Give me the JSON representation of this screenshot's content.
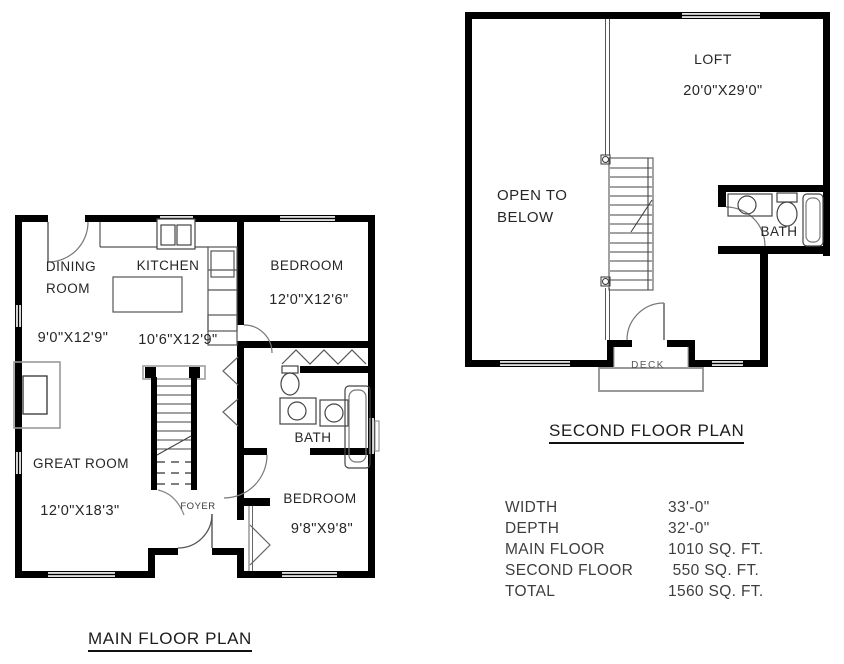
{
  "colors": {
    "wall": "#000000",
    "thin_line": "#4a4a4a",
    "fixture_gray": "#999999",
    "text": "#262626",
    "background": "#ffffff"
  },
  "main_floor": {
    "title": "MAIN FLOOR PLAN",
    "dining": {
      "name_lines": [
        "DINING",
        "ROOM"
      ],
      "dims": "9'0\"X12'9\""
    },
    "kitchen": {
      "name": "KITCHEN",
      "dims": "10'6\"X12'9\""
    },
    "bedroom1": {
      "name": "BEDROOM",
      "dims": "12'0\"X12'6\""
    },
    "great_room": {
      "name": "GREAT ROOM",
      "dims": "12'0\"X18'3\""
    },
    "bath": {
      "name": "BATH"
    },
    "foyer": {
      "name": "FOYER"
    },
    "bedroom2": {
      "name": "BEDROOM",
      "dims": "9'8\"X9'8\""
    }
  },
  "second_floor": {
    "title": "SECOND FLOOR PLAN",
    "loft": {
      "name": "LOFT",
      "dims": "20'0\"X29'0\""
    },
    "open_to_below": {
      "name_lines": [
        "OPEN TO",
        "BELOW"
      ]
    },
    "bath": {
      "name": "BATH"
    },
    "deck": {
      "name": "DECK"
    }
  },
  "stats": {
    "rows": [
      {
        "label": "WIDTH",
        "value": "33'-0\""
      },
      {
        "label": "DEPTH",
        "value": "32'-0\""
      },
      {
        "label": "MAIN FLOOR",
        "value": "1010 SQ. FT."
      },
      {
        "label": "SECOND FLOOR",
        "value": " 550 SQ. FT."
      },
      {
        "label": "TOTAL",
        "value": "1560 SQ. FT."
      }
    ]
  }
}
